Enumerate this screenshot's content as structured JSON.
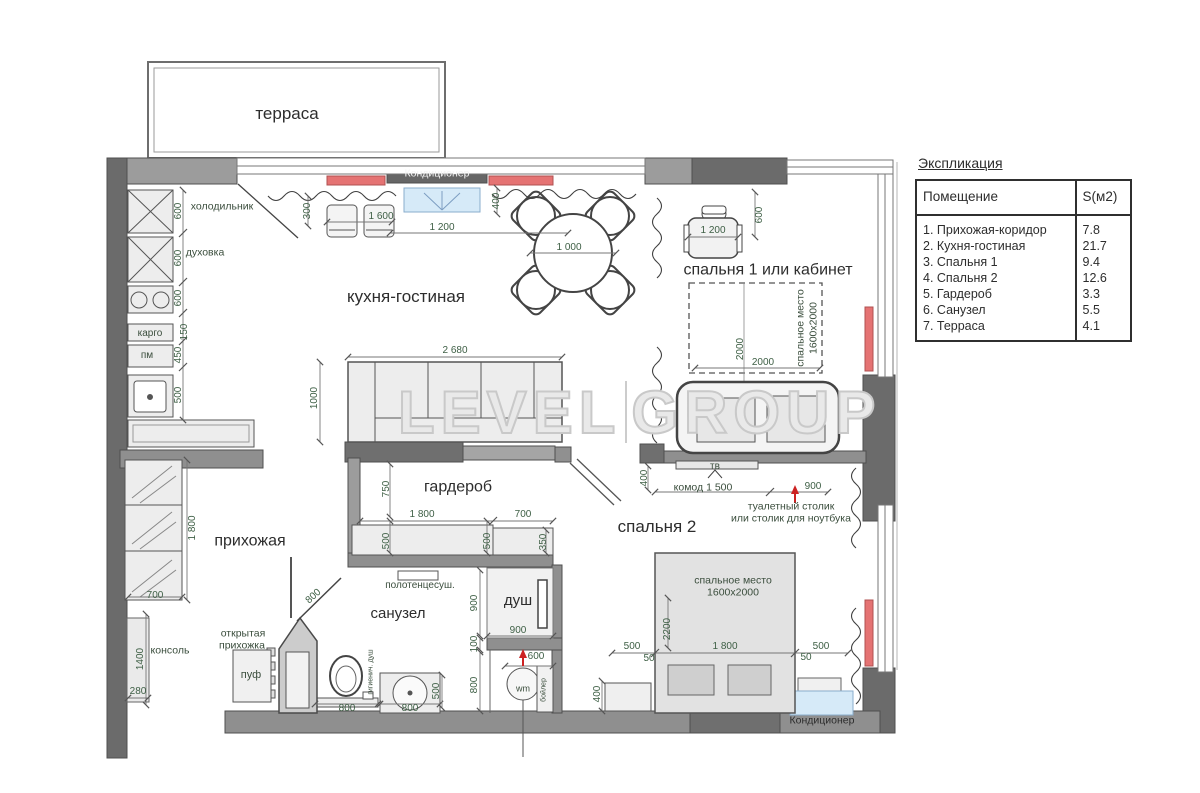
{
  "legend": {
    "title": "Экспликация",
    "col_room": "Помещение",
    "col_area": "S(м2)",
    "rows": [
      {
        "name": "1. Прихожая-коридор",
        "area": "7.8"
      },
      {
        "name": "2. Кухня-гостиная",
        "area": "21.7"
      },
      {
        "name": "3. Спальня 1",
        "area": "9.4"
      },
      {
        "name": "4. Спальня 2",
        "area": "12.6"
      },
      {
        "name": "5. Гардероб",
        "area": "3.3"
      },
      {
        "name": "6. Санузел",
        "area": "5.5"
      },
      {
        "name": "7. Терраса",
        "area": "4.1"
      }
    ]
  },
  "watermark": {
    "word1": "LEVEL",
    "word2": "GROUP"
  },
  "colors": {
    "wall_dark": "#6b6b6b",
    "wall_medium": "#8f8f8f",
    "radiator_red": "#e57373",
    "ac_blue": "#d6eaf8",
    "dim_text": "#3e5f45",
    "label_text": "#2d2d2d",
    "watermark_gray": "#c9c9c9"
  },
  "plan_texts": [
    {
      "n": "terrace-label",
      "t": "терраса",
      "x": 287,
      "y": 114,
      "s": 17,
      "c": "room"
    },
    {
      "n": "kitchen-living-label",
      "t": "кухня-гостиная",
      "x": 406,
      "y": 297,
      "s": 17,
      "c": "room"
    },
    {
      "n": "bedroom1-label",
      "t": "спальня 1 или кабинет",
      "x": 768,
      "y": 271,
      "s": 16,
      "c": "room"
    },
    {
      "n": "wardrobe-label",
      "t": "гардероб",
      "x": 458,
      "y": 488,
      "s": 16,
      "c": "room"
    },
    {
      "n": "bedroom2-label",
      "t": "спальня 2",
      "x": 657,
      "y": 527,
      "s": 17,
      "c": "room"
    },
    {
      "n": "hallway-label",
      "t": "прихожая",
      "x": 250,
      "y": 542,
      "s": 16,
      "c": "room"
    },
    {
      "n": "bathroom-label",
      "t": "санузел",
      "x": 398,
      "y": 614,
      "s": 15,
      "c": "room"
    },
    {
      "n": "shower-label",
      "t": "душ",
      "x": 518,
      "y": 601,
      "s": 15,
      "c": "room"
    },
    {
      "n": "fridge-label",
      "t": "холодильник",
      "x": 222,
      "y": 207,
      "s": 10.5,
      "c": "small"
    },
    {
      "n": "oven-label",
      "t": "духовка",
      "x": 205,
      "y": 253,
      "s": 10.5,
      "c": "small"
    },
    {
      "n": "cargo-label",
      "t": "карго",
      "x": 150,
      "y": 334,
      "s": 10,
      "c": "small"
    },
    {
      "n": "dishwasher-label",
      "t": "пм",
      "x": 147,
      "y": 356,
      "s": 10,
      "c": "small"
    },
    {
      "n": "towel-dryer-label",
      "t": "полотенцесуш.",
      "x": 420,
      "y": 586,
      "s": 10,
      "c": "small"
    },
    {
      "n": "open-hallway-label-1",
      "t": "открытая",
      "x": 243,
      "y": 634,
      "s": 10.5,
      "c": "small"
    },
    {
      "n": "open-hallway-label-2",
      "t": "прихожка",
      "x": 242,
      "y": 646,
      "s": 10.5,
      "c": "small"
    },
    {
      "n": "pouf-label",
      "t": "пуф",
      "x": 251,
      "y": 676,
      "s": 11,
      "c": "small"
    },
    {
      "n": "console-label",
      "t": "консоль",
      "x": 170,
      "y": 651,
      "s": 10.5,
      "c": "small"
    },
    {
      "n": "tv-label-bedroom2",
      "t": "тв",
      "x": 715,
      "y": 467,
      "s": 10,
      "c": "small"
    },
    {
      "n": "dresser-label",
      "t": "комод 1 500",
      "x": 703,
      "y": 488,
      "s": 10.5,
      "c": "small"
    },
    {
      "n": "vanity-label-1",
      "t": "туалетный столик",
      "x": 791,
      "y": 507,
      "s": 10.5,
      "c": "small"
    },
    {
      "n": "vanity-label-2",
      "t": "или столик для ноутбука",
      "x": 791,
      "y": 519,
      "s": 10.5,
      "c": "small"
    },
    {
      "n": "bed2-zone-label-1",
      "t": "спальное место",
      "x": 733,
      "y": 581,
      "s": 10.5,
      "c": "small"
    },
    {
      "n": "bed2-zone-label-2",
      "t": "1600х2000",
      "x": 733,
      "y": 593,
      "s": 10.5,
      "c": "small"
    },
    {
      "n": "bed1-zone-label-1",
      "t": "спальное место",
      "x": 801,
      "y": 328,
      "s": 10.5,
      "c": "small",
      "r": -90
    },
    {
      "n": "bed1-zone-label-2",
      "t": "1600х2000",
      "x": 814,
      "y": 328,
      "s": 10.5,
      "c": "small",
      "r": -90
    },
    {
      "n": "washing-machine-label",
      "t": "wm",
      "x": 523,
      "y": 689,
      "s": 9,
      "c": "small"
    },
    {
      "n": "boiler-label",
      "t": "бойлер",
      "x": 544,
      "y": 690,
      "s": 7,
      "c": "small",
      "r": -90
    },
    {
      "n": "hygienic-shower-label",
      "t": "гигиенич. душ",
      "x": 371,
      "y": 672,
      "s": 7,
      "c": "small",
      "r": -90
    },
    {
      "n": "ac-label-top",
      "t": "Кондиционер",
      "x": 437,
      "y": 174,
      "s": 10.5,
      "c": "white"
    },
    {
      "n": "ac-label-bottom",
      "t": "Кондиционер",
      "x": 822,
      "y": 721,
      "s": 10.5,
      "c": "dark"
    },
    {
      "n": "dim-300",
      "t": "300",
      "x": 308,
      "y": 211,
      "s": 10,
      "c": "dim",
      "r": -90
    },
    {
      "n": "dim-1600",
      "t": "1 600",
      "x": 381,
      "y": 217,
      "s": 10,
      "c": "dim"
    },
    {
      "n": "dim-1200-top",
      "t": "1 200",
      "x": 442,
      "y": 228,
      "s": 10,
      "c": "dim"
    },
    {
      "n": "dim-400-top",
      "t": "400",
      "x": 497,
      "y": 201,
      "s": 10,
      "c": "dim",
      "r": -90
    },
    {
      "n": "dim-1000-table",
      "t": "1 000",
      "x": 569,
      "y": 248,
      "s": 10,
      "c": "dim"
    },
    {
      "n": "dim-1200-desk",
      "t": "1 200",
      "x": 713,
      "y": 231,
      "s": 10,
      "c": "dim"
    },
    {
      "n": "dim-600-desk",
      "t": "600",
      "x": 760,
      "y": 215,
      "s": 10,
      "c": "dim",
      "r": -90
    },
    {
      "n": "dim-2000-v",
      "t": "2000",
      "x": 741,
      "y": 349,
      "s": 10,
      "c": "dim",
      "r": -90
    },
    {
      "n": "dim-2000-h",
      "t": "2000",
      "x": 763,
      "y": 363,
      "s": 10,
      "c": "dim"
    },
    {
      "n": "dim-2680",
      "t": "2 680",
      "x": 455,
      "y": 351,
      "s": 10,
      "c": "dim"
    },
    {
      "n": "dim-1000-sofa",
      "t": "1000",
      "x": 315,
      "y": 398,
      "s": 10,
      "c": "dim",
      "r": -90
    },
    {
      "n": "dim-600-fridge",
      "t": "600",
      "x": 179,
      "y": 211,
      "s": 10,
      "c": "dim",
      "r": -90
    },
    {
      "n": "dim-600-oven",
      "t": "600",
      "x": 179,
      "y": 258,
      "s": 10,
      "c": "dim",
      "r": -90
    },
    {
      "n": "dim-600-hob",
      "t": "600",
      "x": 179,
      "y": 298,
      "s": 10,
      "c": "dim",
      "r": -90
    },
    {
      "n": "dim-150-cargo",
      "t": "150",
      "x": 185,
      "y": 332,
      "s": 10,
      "c": "dim",
      "r": -90
    },
    {
      "n": "dim-450-pm",
      "t": "450",
      "x": 179,
      "y": 355,
      "s": 10,
      "c": "dim",
      "r": -90
    },
    {
      "n": "dim-500-sink",
      "t": "500",
      "x": 179,
      "y": 395,
      "s": 10,
      "c": "dim",
      "r": -90
    },
    {
      "n": "dim-750-wardrobe",
      "t": "750",
      "x": 387,
      "y": 489,
      "s": 10,
      "c": "dim",
      "r": -90
    },
    {
      "n": "dim-1800-wardrobe",
      "t": "1 800",
      "x": 422,
      "y": 515,
      "s": 10,
      "c": "dim"
    },
    {
      "n": "dim-700-wardrobe",
      "t": "700",
      "x": 523,
      "y": 515,
      "s": 10,
      "c": "dim"
    },
    {
      "n": "dim-500-wardrobe-a",
      "t": "500",
      "x": 387,
      "y": 541,
      "s": 10,
      "c": "dim",
      "r": -90
    },
    {
      "n": "dim-500-wardrobe-b",
      "t": "500",
      "x": 488,
      "y": 541,
      "s": 10,
      "c": "dim",
      "r": -90
    },
    {
      "n": "dim-350-wardrobe",
      "t": "350",
      "x": 544,
      "y": 542,
      "s": 10,
      "c": "dim",
      "r": -90
    },
    {
      "n": "dim-400-bedroom2-top",
      "t": "400",
      "x": 645,
      "y": 478,
      "s": 10,
      "c": "dim",
      "r": -90
    },
    {
      "n": "dim-900-vanity",
      "t": "900",
      "x": 813,
      "y": 487,
      "s": 10,
      "c": "dim"
    },
    {
      "n": "dim-500-bed-left",
      "t": "500",
      "x": 632,
      "y": 647,
      "s": 10,
      "c": "dim"
    },
    {
      "n": "dim-50-bed-left",
      "t": "50",
      "x": 649,
      "y": 659,
      "s": 10,
      "c": "dim"
    },
    {
      "n": "dim-1800-bed",
      "t": "1 800",
      "x": 725,
      "y": 647,
      "s": 10,
      "c": "dim"
    },
    {
      "n": "dim-50-bed-right",
      "t": "50",
      "x": 806,
      "y": 658,
      "s": 10,
      "c": "dim"
    },
    {
      "n": "dim-500-bed-right",
      "t": "500",
      "x": 821,
      "y": 647,
      "s": 10,
      "c": "dim"
    },
    {
      "n": "dim-2200-bed",
      "t": "2200",
      "x": 668,
      "y": 629,
      "s": 10,
      "c": "dim",
      "r": -90
    },
    {
      "n": "dim-400-nightstand",
      "t": "400",
      "x": 598,
      "y": 694,
      "s": 10,
      "c": "dim",
      "r": -90
    },
    {
      "n": "dim-800-door",
      "t": "800",
      "x": 314,
      "y": 597,
      "s": 10,
      "c": "dim",
      "r": -42
    },
    {
      "n": "dim-900-shower-v",
      "t": "900",
      "x": 475,
      "y": 603,
      "s": 10,
      "c": "dim",
      "r": -90
    },
    {
      "n": "dim-900-shower-h",
      "t": "900",
      "x": 518,
      "y": 631,
      "s": 10,
      "c": "dim"
    },
    {
      "n": "dim-100",
      "t": "100",
      "x": 475,
      "y": 644,
      "s": 10,
      "c": "dim",
      "r": -90
    },
    {
      "n": "dim-600-wm",
      "t": "600",
      "x": 536,
      "y": 657,
      "s": 10,
      "c": "dim"
    },
    {
      "n": "dim-800-wm",
      "t": "800",
      "x": 475,
      "y": 685,
      "s": 10,
      "c": "dim",
      "r": -90
    },
    {
      "n": "dim-800-toilet",
      "t": "800",
      "x": 347,
      "y": 709,
      "s": 10,
      "c": "dim"
    },
    {
      "n": "dim-800-basin",
      "t": "800",
      "x": 410,
      "y": 709,
      "s": 10,
      "c": "dim"
    },
    {
      "n": "dim-500-basin",
      "t": "500",
      "x": 437,
      "y": 691,
      "s": 10,
      "c": "dim",
      "r": -90
    },
    {
      "n": "dim-1800-hall",
      "t": "1 800",
      "x": 193,
      "y": 528,
      "s": 10,
      "c": "dim",
      "r": -90
    },
    {
      "n": "dim-700-hall",
      "t": "700",
      "x": 155,
      "y": 596,
      "s": 10,
      "c": "dim"
    },
    {
      "n": "dim-1400-hall",
      "t": "1400",
      "x": 141,
      "y": 659,
      "s": 10,
      "c": "dim",
      "r": -90
    },
    {
      "n": "dim-280-hall",
      "t": "280",
      "x": 138,
      "y": 692,
      "s": 10,
      "c": "dim"
    }
  ]
}
